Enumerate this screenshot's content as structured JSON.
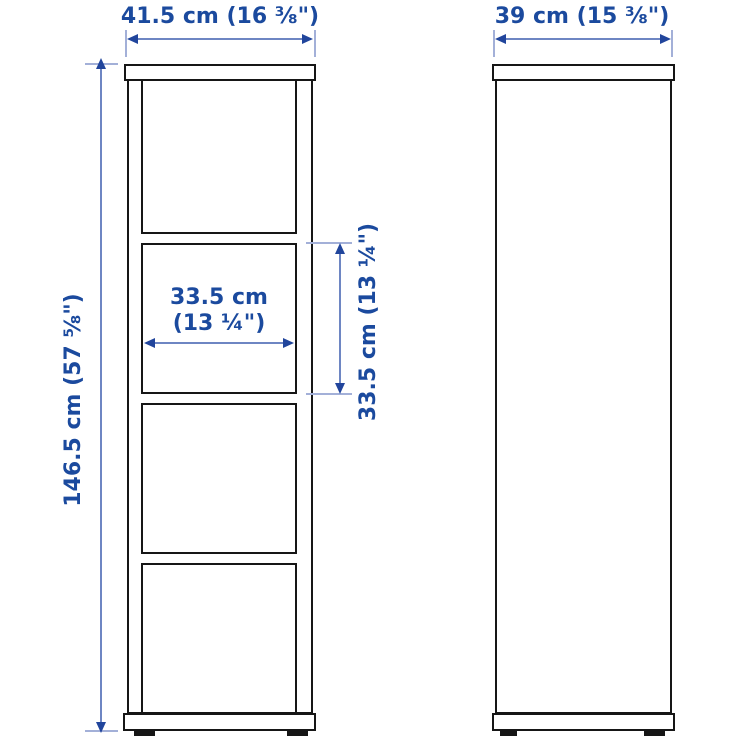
{
  "diagram": {
    "kind": "product-dimension-drawing",
    "accent_color": "#1b4a9e",
    "outline_color": "#161616",
    "front_view": {
      "width_label": "41.5 cm (16 ⅜\")",
      "height_label": "146.5 cm (57 ⅝\")",
      "inner_width_label_line1": "33.5 cm",
      "inner_width_label_line2": "(13 ¼\")",
      "inner_height_label": "33.5 cm (13 ¼\")",
      "compartment_count": 4
    },
    "side_view": {
      "depth_label": "39 cm (15 ⅜\")"
    }
  }
}
